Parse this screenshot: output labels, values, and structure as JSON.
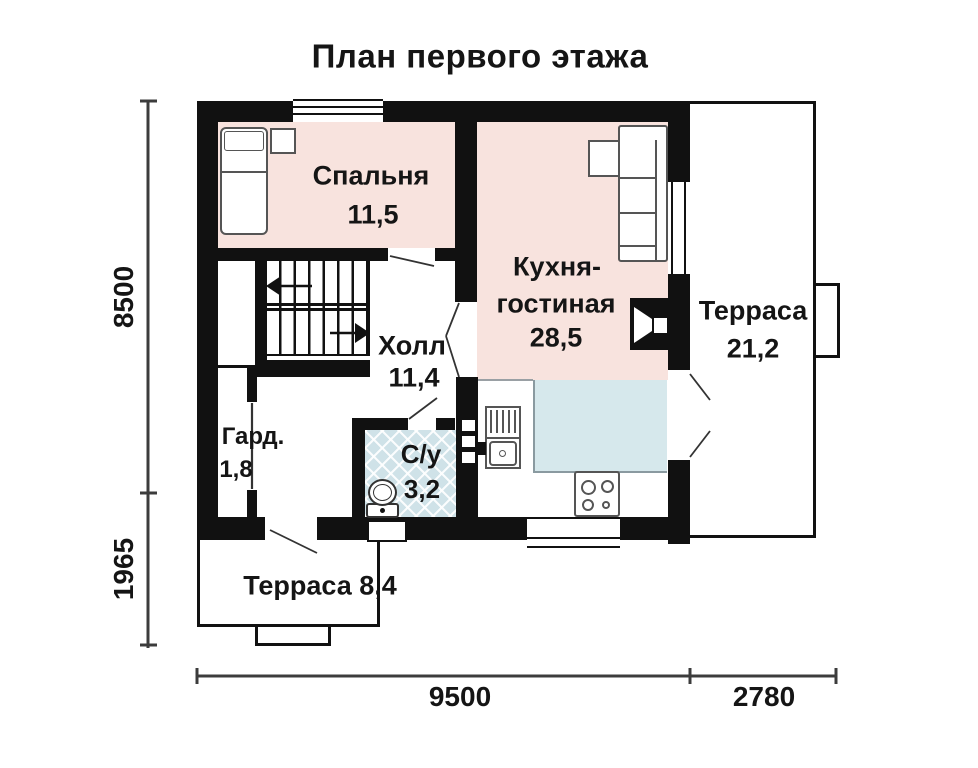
{
  "title": "План первого этажа",
  "rooms": {
    "bedroom": {
      "name": "Спальня",
      "area": "11,5"
    },
    "kitchen_living": {
      "name_line1": "Кухня-",
      "name_line2": "гостиная",
      "area": "28,5"
    },
    "terrace_right": {
      "name": "Терраса",
      "area": "21,2"
    },
    "hall": {
      "name": "Холл",
      "area": "11,4"
    },
    "wardrobe": {
      "name": "Гард.",
      "area": "1,8"
    },
    "bathroom": {
      "name": "С/у",
      "area": "3,2"
    },
    "terrace_front": {
      "name": "Терраса",
      "area": "8,4"
    }
  },
  "dimensions": {
    "left_upper": "8500",
    "left_lower": "1965",
    "bottom_house": "9500",
    "bottom_terrace": "2780"
  },
  "colors": {
    "wall": "#111111",
    "room_fill_pink": "#f8e3de",
    "bathroom_tile": "#cfe2e8",
    "kitchen_floor_blue": "#d6e8ec",
    "dimension_line": "#3c3c3c"
  },
  "furniture_icons": [
    "bed-icon",
    "nightstand-icon",
    "sofa-icon",
    "stairs-icon",
    "toilet-icon",
    "sink-icon",
    "stove-icon",
    "fireplace-icon",
    "window-icon",
    "door-swing-icon"
  ]
}
